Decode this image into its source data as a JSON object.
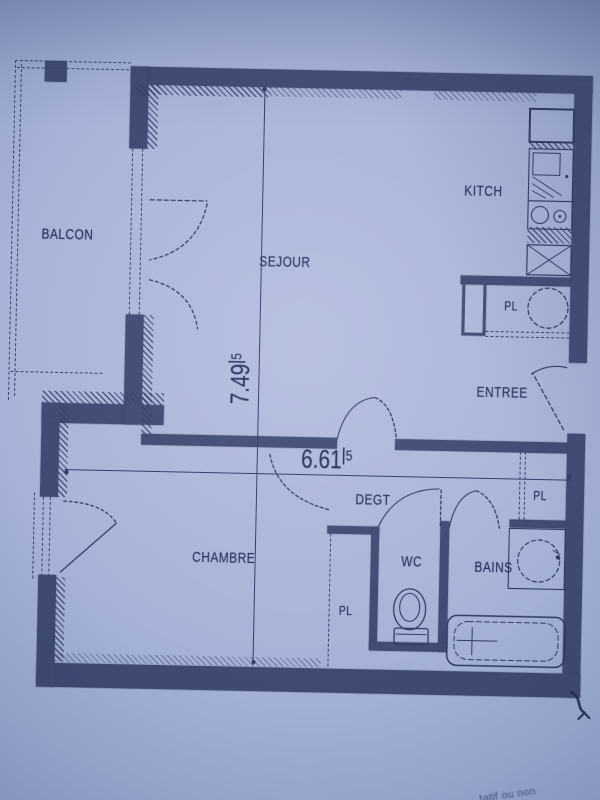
{
  "rooms": {
    "balcon": "BALCON",
    "sejour": "SEJOUR",
    "kitchen": "KITCH",
    "entree": "ENTREE",
    "degagement": "DEGT",
    "chambre": "CHAMBRE",
    "wc": "WC",
    "bains": "BAINS"
  },
  "closets": {
    "kitchen": "PL",
    "entree": "PL",
    "chambre": "PL"
  },
  "dimensions": {
    "vertical": {
      "value": "7.49",
      "sup": "5"
    },
    "horizontal": {
      "value": "6.61",
      "sup": "5"
    }
  },
  "annotations": {
    "corner_text_fragment": "tatif ou non"
  },
  "colors": {
    "paper": "#a9b4d9",
    "ink": "#2e3a63",
    "wall": "#3e4a72"
  }
}
